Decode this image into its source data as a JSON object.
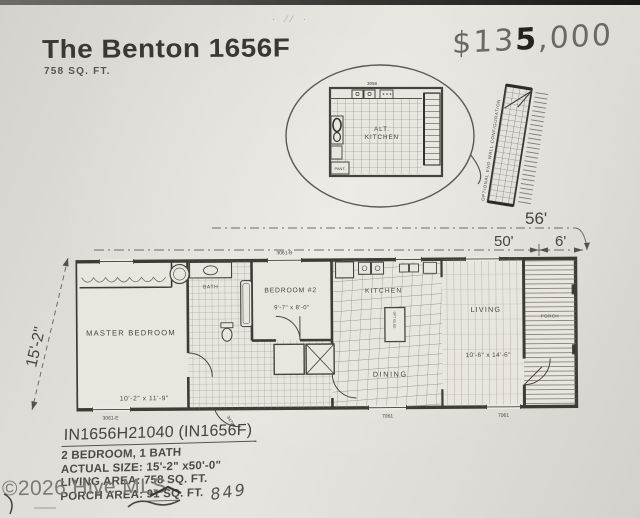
{
  "header": {
    "title": "The Benton 1656F",
    "subtitle": "758 SQ. FT.",
    "price_prefix": "$13",
    "price_bold": "5",
    "price_suffix": ",000",
    "stray_marks": "· ⁄⁄ ·"
  },
  "inset": {
    "top_label": "3058",
    "label_line1": "ALT.",
    "label_line2": "KITCHEN",
    "pantry_label": "PANT."
  },
  "side_panel": {
    "label": "OPTIONAL END WALL CONFIGURATION"
  },
  "dimensions": {
    "overall_length": "56'",
    "body_length": "50'",
    "porch_length": "6'",
    "width": "15'-2\""
  },
  "plan": {
    "master_bedroom": {
      "name": "MASTER BEDROOM",
      "size": "10'-2\" x 11'-9\""
    },
    "bedroom2": {
      "name": "BEDROOM #2",
      "size": "9'-7\" x 8'-0\""
    },
    "bath": {
      "name": "BATH"
    },
    "kitchen": {
      "name": "KITCHEN"
    },
    "dining": {
      "name": "DINING"
    },
    "living": {
      "name": "LIVING",
      "size": "10'-6\" x 14'-6\""
    },
    "porch": {
      "name": "PORCH"
    },
    "labels": {
      "window_master_bottom": "3061-E",
      "window_bedroom2_top": "3061-B",
      "window_dining_bottom": "7061",
      "window_living_bottom": "7061",
      "door_hall": "3476",
      "island": "OPT ISLND"
    }
  },
  "footer": {
    "model": "IN1656H21040 (IN1656F)",
    "specs": [
      "2 BEDROOM, 1 BATH",
      "ACTUAL SIZE: 15'-2\" x50'-0\"",
      "LIVING AREA: 758 SQ. FT."
    ],
    "porch_line": {
      "prefix": "PORCH AREA: ",
      "underlined": "91 SQ",
      "suffix": ". FT."
    },
    "handwritten_note": "849",
    "watermark": "©2026 Hive MLS"
  },
  "colors": {
    "paper": "#e2dfd9",
    "ink": "#3e3b35",
    "pencil": "#5f5d58",
    "watermark": "#7c7a74"
  }
}
